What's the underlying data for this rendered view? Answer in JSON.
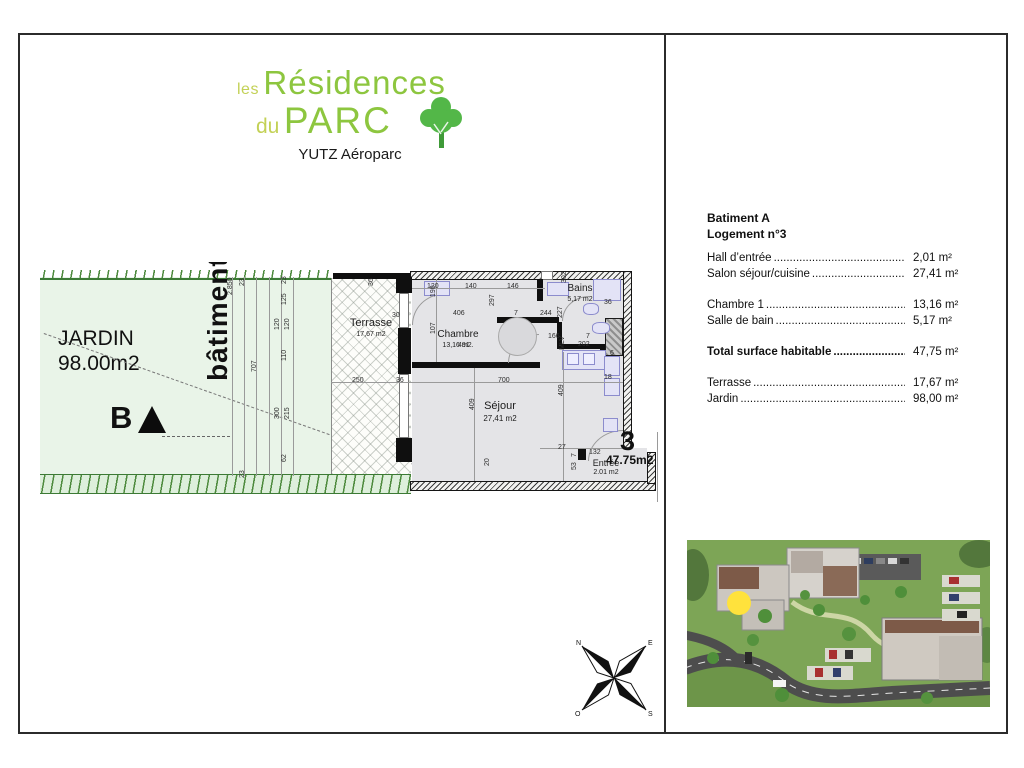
{
  "logo": {
    "prefix1": "les",
    "main1": "Résidences",
    "prefix2": "du",
    "main2": "PARC",
    "subtitle": "YUTZ Aéroparc"
  },
  "colors": {
    "logo_light_green": "#c3d156",
    "logo_green": "#8dc63f",
    "tree_green": "#53b748",
    "garden_fill": "#e9f4e8",
    "garden_edge": "#3c7a35",
    "room_fill": "#e4e4e7",
    "fixture_blue": "#e3e3f6",
    "marker_yellow": "#ffe23c"
  },
  "plan": {
    "garden": {
      "name": "JARDIN",
      "area": "98.00m2"
    },
    "building_label": "bâtiment",
    "marker": "B",
    "terrace": {
      "name": "Terrasse",
      "area": "17,67 m2"
    },
    "chambre": {
      "name": "Chambre",
      "area": "13,16 m2."
    },
    "bains": {
      "name": "Bains",
      "area": "5,17 m2"
    },
    "sejour": {
      "name": "Séjour",
      "area": "27,41 m2"
    },
    "entree": {
      "name": "Entrée",
      "area": "2.01 m2"
    },
    "unit": {
      "number": "3",
      "area": "47.75m2"
    },
    "compass": {
      "n": "N",
      "e": "E",
      "o": "O",
      "s": "S"
    },
    "dims": [
      {
        "t": "2.850",
        "x": 227,
        "y": 295,
        "r": 1
      },
      {
        "t": "23",
        "x": 239,
        "y": 286,
        "r": 1
      },
      {
        "t": "707",
        "x": 251,
        "y": 372,
        "r": 1
      },
      {
        "t": "23",
        "x": 239,
        "y": 478,
        "r": 1
      },
      {
        "t": "23",
        "x": 281,
        "y": 284,
        "r": 1
      },
      {
        "t": "125",
        "x": 281,
        "y": 305,
        "r": 1
      },
      {
        "t": "120",
        "x": 274,
        "y": 330,
        "r": 1
      },
      {
        "t": "120",
        "x": 284,
        "y": 330,
        "r": 1
      },
      {
        "t": "110",
        "x": 281,
        "y": 361,
        "r": 1
      },
      {
        "t": "300",
        "x": 274,
        "y": 419,
        "r": 1
      },
      {
        "t": "215",
        "x": 284,
        "y": 419,
        "r": 1
      },
      {
        "t": "62",
        "x": 281,
        "y": 462,
        "r": 1
      },
      {
        "t": "36",
        "x": 368,
        "y": 286,
        "r": 1
      },
      {
        "t": "30",
        "x": 392,
        "y": 312
      },
      {
        "t": "250",
        "x": 352,
        "y": 377
      },
      {
        "t": "36",
        "x": 396,
        "y": 377
      },
      {
        "t": "700",
        "x": 498,
        "y": 377
      },
      {
        "t": "120",
        "x": 427,
        "y": 283
      },
      {
        "t": "140",
        "x": 465,
        "y": 283
      },
      {
        "t": "146",
        "x": 507,
        "y": 283
      },
      {
        "t": "190",
        "x": 430,
        "y": 297,
        "r": 1
      },
      {
        "t": "406",
        "x": 453,
        "y": 310
      },
      {
        "t": "297",
        "x": 489,
        "y": 306,
        "r": 1
      },
      {
        "t": "7",
        "x": 514,
        "y": 310
      },
      {
        "t": "107",
        "x": 430,
        "y": 334,
        "r": 1
      },
      {
        "t": "491",
        "x": 458,
        "y": 342
      },
      {
        "t": "244",
        "x": 540,
        "y": 310
      },
      {
        "t": "227",
        "x": 557,
        "y": 318,
        "r": 1
      },
      {
        "t": "302",
        "x": 561,
        "y": 283,
        "r": 1
      },
      {
        "t": "36",
        "x": 604,
        "y": 299
      },
      {
        "t": "166",
        "x": 548,
        "y": 333
      },
      {
        "t": "7",
        "x": 586,
        "y": 333
      },
      {
        "t": "202",
        "x": 578,
        "y": 341
      },
      {
        "t": "MLV",
        "x": 559,
        "y": 350,
        "r": 1
      },
      {
        "t": "6",
        "x": 610,
        "y": 350
      },
      {
        "t": "409",
        "x": 469,
        "y": 410,
        "r": 1
      },
      {
        "t": "409",
        "x": 558,
        "y": 396,
        "r": 1
      },
      {
        "t": "18",
        "x": 604,
        "y": 374
      },
      {
        "t": "20",
        "x": 484,
        "y": 466,
        "r": 1
      },
      {
        "t": "27",
        "x": 558,
        "y": 444
      },
      {
        "t": "132",
        "x": 589,
        "y": 449
      },
      {
        "t": "7",
        "x": 571,
        "y": 457,
        "r": 1
      },
      {
        "t": "53",
        "x": 571,
        "y": 470,
        "r": 1
      }
    ]
  },
  "info": {
    "title1": "Batiment A",
    "title2": "Logement n°3",
    "rows": [
      {
        "label": "Hall d’entrée",
        "value": "2,01 m²"
      },
      {
        "label": "Salon séjour/cuisine",
        "value": "27,41 m²"
      },
      {
        "label": "Chambre 1",
        "value": "13,16 m²",
        "gap_before": true
      },
      {
        "label": "Salle de bain",
        "value": "5,17 m²"
      },
      {
        "label": "Total surface habitable",
        "value": "47,75 m²",
        "bold": true,
        "gap_before": true
      },
      {
        "label": "Terrasse",
        "value": "17,67 m²",
        "gap_before": true
      },
      {
        "label": "Jardin",
        "value": "98,00 m²"
      }
    ]
  }
}
